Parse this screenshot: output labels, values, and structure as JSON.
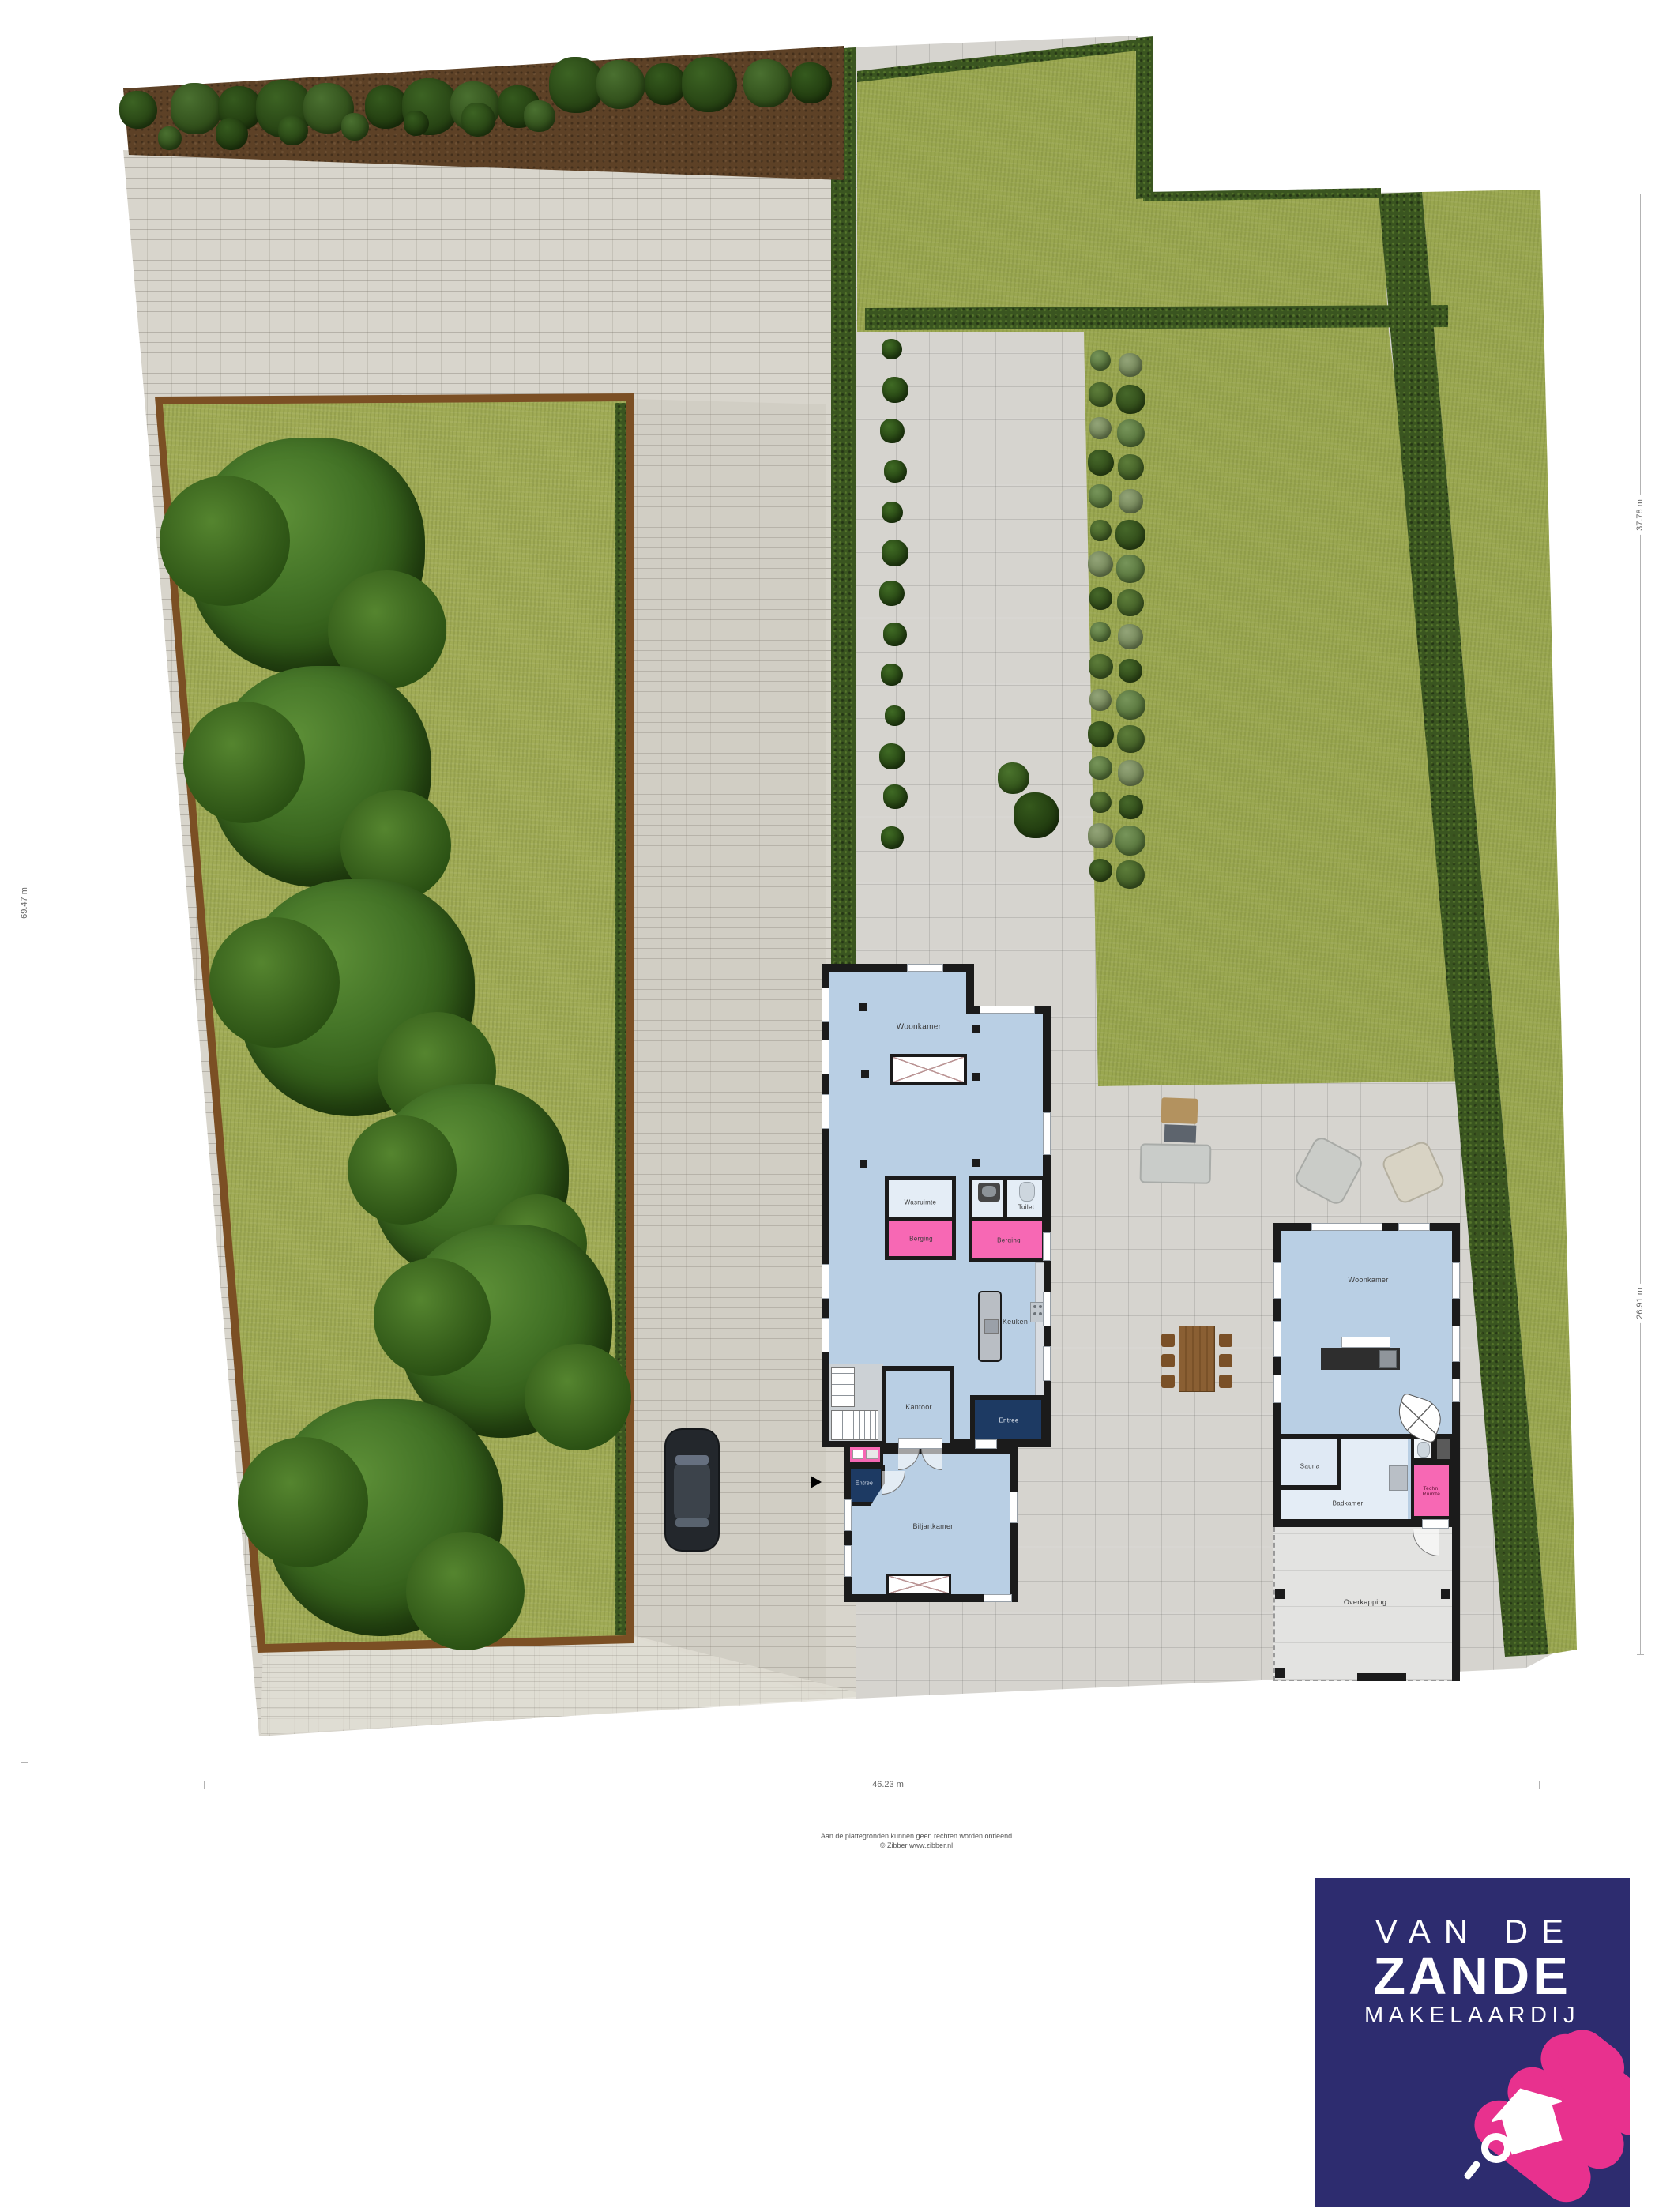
{
  "dimensions": {
    "left": "69.47 m",
    "right_top": "37.78 m",
    "right_bottom": "26.91 m",
    "bottom": "46.23 m"
  },
  "main_house": {
    "woonkamer": "Woonkamer",
    "wasruimte": "Wasruimte",
    "toilet": "Toilet",
    "berging_left": "Berging",
    "berging_right": "Berging",
    "keuken": "Keuken",
    "kantoor": "Kantoor",
    "entree_front": "Entree",
    "entree_side": "Entree",
    "biljartkamer": "Biljartkamer"
  },
  "guest_house": {
    "woonkamer": "Woonkamer",
    "sauna": "Sauna",
    "badkamer": "Badkamer",
    "techn_ruimte": "Techn. Ruimte",
    "overkapping": "Overkapping"
  },
  "disclaimer": {
    "line1": "Aan de plattegronden kunnen geen rechten worden ontleend",
    "line2": "© Zibber www.zibber.nl"
  },
  "logo": {
    "line1": "VAN DE",
    "line2": "ZANDE",
    "line3": "MAKELAARDIJ"
  },
  "colors": {
    "room_blue": "#b9cfe4",
    "room_light": "#e4edf6",
    "room_pink": "#f768b4",
    "entree_navy": "#1d3a63",
    "wall": "#1b1b1b",
    "grass": "#9aa750",
    "hedge": "#3a5520",
    "logo_navy": "#2d2c6f",
    "logo_pink": "#e8318e"
  }
}
